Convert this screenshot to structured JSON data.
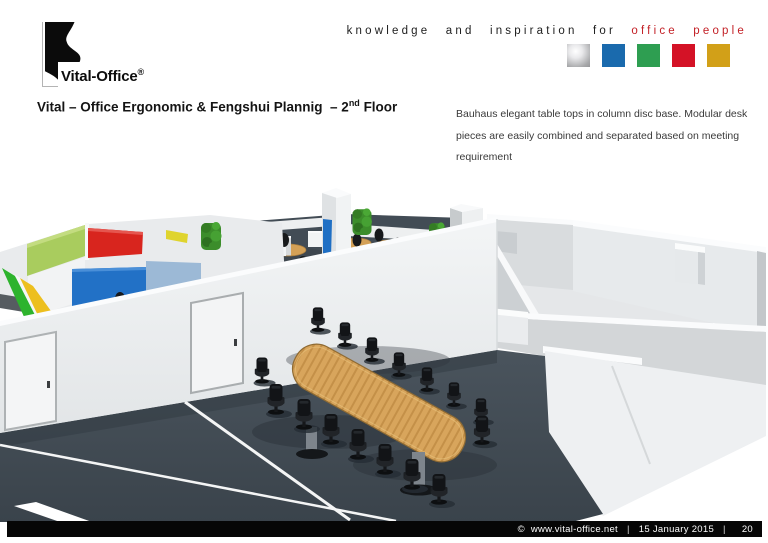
{
  "header": {
    "logo": {
      "wordmark": "Vital-Office",
      "registered": "®"
    },
    "tagline": {
      "dark": "knowledge and inspiration for",
      "accent": "office people",
      "accent_color": "#c32026"
    },
    "brand_squares": [
      {
        "name": "silver",
        "color": "#a8a9ab"
      },
      {
        "name": "blue",
        "color": "#1a6aad"
      },
      {
        "name": "green",
        "color": "#2e9e51"
      },
      {
        "name": "red",
        "color": "#d41226"
      },
      {
        "name": "gold",
        "color": "#d2a018"
      }
    ]
  },
  "title": {
    "part1": "Vital – Office Ergonomic & Fengshui Plannig  – 2",
    "superscript": "nd",
    "part2": " Floor"
  },
  "description": {
    "lines": [
      "Bauhaus elegant table tops in column disc base. Modular desk",
      "pieces are easily combined and separated based on meeting",
      "requirement"
    ]
  },
  "scene": {
    "colors": {
      "carpet": "#414a53",
      "walls": "#eef0f2",
      "table_wood": "#d8a55c",
      "chairs": "#15171a",
      "plants": "#3c8d2b",
      "panel_green": "#a9cc5e",
      "panel_red": "#d8251e",
      "panel_blue": "#2271c6",
      "panel_lightblue": "#9cb9d6",
      "panel_yellow": "#edbf1e",
      "column_stripe_blue": "#1f6fc4"
    }
  },
  "footer": {
    "copyright_url": "©  www.vital-office.net",
    "separator": "|",
    "date": "15 January 2015",
    "page_number": "20"
  }
}
